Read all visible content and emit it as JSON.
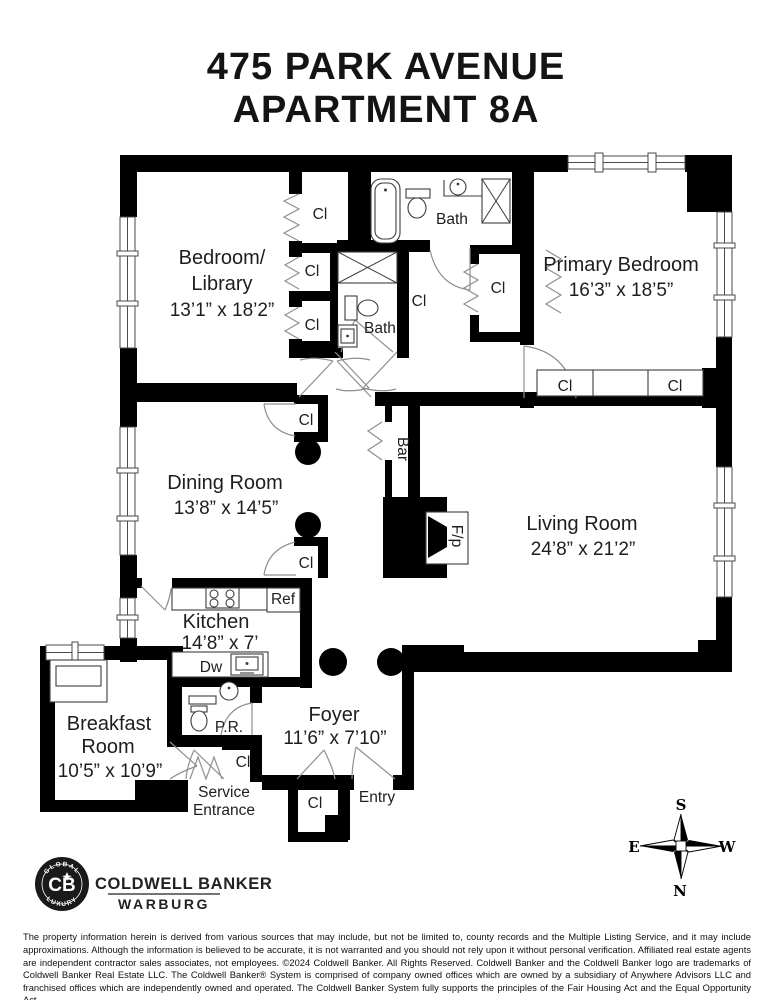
{
  "title": {
    "line1": "475 PARK AVENUE",
    "line2": "APARTMENT 8A"
  },
  "rooms": {
    "bedroom_library": {
      "l1": "Bedroom/",
      "l2": "Library",
      "dims": "13’1” x 18’2”"
    },
    "primary_bedroom": {
      "l1": "Primary Bedroom",
      "dims": "16’3” x 18’5”"
    },
    "dining": {
      "l1": "Dining Room",
      "dims": "13’8” x 14’5”"
    },
    "living": {
      "l1": "Living Room",
      "dims": "24’8” x 21’2”"
    },
    "kitchen": {
      "l1": "Kitchen",
      "dims": "14’8” x 7’"
    },
    "breakfast": {
      "l1": "Breakfast",
      "l2": "Room",
      "dims": "10’5” x 10’9”"
    },
    "foyer": {
      "l1": "Foyer",
      "dims": "11’6” x 7’10”"
    }
  },
  "labels": {
    "cl": "Cl",
    "bath": "Bath",
    "bar": "Bar",
    "fp": "F/p",
    "ref": "Ref",
    "dw": "Dw",
    "pr": "P.R.",
    "entry": "Entry",
    "service1": "Service",
    "service2": "Entrance"
  },
  "compass": {
    "n": "N",
    "s": "S",
    "e": "E",
    "w": "W"
  },
  "brand": {
    "badge_center": "CB",
    "badge_top": "GLOBAL",
    "badge_bottom": "LUXURY",
    "name": "COLDWELL BANKER",
    "division": "WARBURG"
  },
  "colors": {
    "wall": "#000000",
    "background": "#ffffff",
    "text": "#1e1e1e"
  },
  "disclaimer": "The property information herein is derived from various sources that may include, but not be limited to, county records and the Multiple Listing Service, and it may include approximations. Although the information is believed to be accurate, it is not warranted and you should not rely upon it without personal verification. Affiliated real estate agents are independent contractor sales associates, not employees. ©2024 Coldwell Banker. All Rights Reserved. Coldwell Banker and the Coldwell Banker logo are trademarks of Coldwell Banker Real Estate LLC. The Coldwell Banker® System is comprised of company owned offices which are owned by a subsidiary of Anywhere Advisors LLC and franchised offices which are independently owned and operated. The Coldwell Banker System fully supports the principles of the Fair Housing Act and the Equal Opportunity Act."
}
